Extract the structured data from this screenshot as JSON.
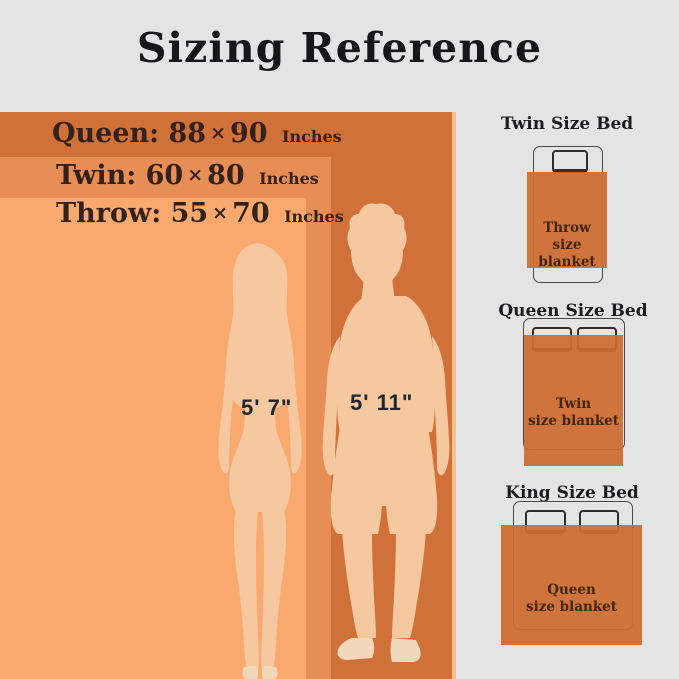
{
  "title": "Sizing Reference",
  "size_chart": {
    "rows": [
      {
        "name": "Queen:",
        "w": "88",
        "sep": "×",
        "h": "90",
        "unit": "Inches"
      },
      {
        "name": "Twin:",
        "w": "60",
        "sep": "×",
        "h": "80",
        "unit": "Inches"
      },
      {
        "name": "Throw:",
        "w": "55",
        "sep": "×",
        "h": "70",
        "unit": "Inches"
      }
    ],
    "woman_height": "5' 7\"",
    "man_height": "5' 11\""
  },
  "beds": [
    {
      "title": "Twin Size Bed",
      "blanket": {
        "line1": "Throw",
        "line2": "size blanket"
      }
    },
    {
      "title": "Queen Size Bed",
      "blanket": {
        "line1": "Twin",
        "line2": "size blanket"
      }
    },
    {
      "title": "King Size Bed",
      "blanket": {
        "line1": "Queen",
        "line2": "size blanket"
      }
    }
  ],
  "colors": {
    "background": "#e4e4e5",
    "queen_rect": "#d1713a",
    "twin_rect": "#e68e55",
    "throw_rect": "#f9a96e",
    "edge_highlight": "#f4c291",
    "silhouette": "#f6c8a0",
    "silhouette_feet": "#f0d8bb",
    "blanket": "#cd6c30",
    "text_dark": "#33211a"
  }
}
